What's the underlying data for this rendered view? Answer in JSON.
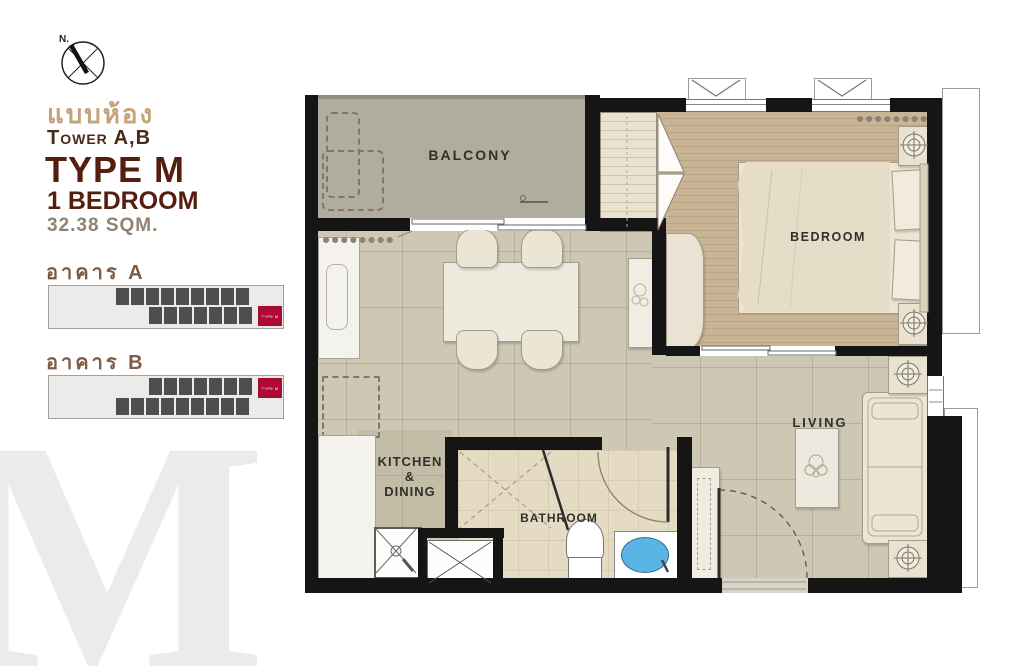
{
  "info_panel": {
    "compass_label": "N.",
    "title_thai": "แบบห้อง",
    "tower": "Tower A,B",
    "type": "TYPE M",
    "bedrooms": "1 BEDROOM",
    "area": "32.38 SQM.",
    "watermark": "M"
  },
  "buildings": [
    {
      "label": "อาคาร A",
      "highlight_label": "TYPE M",
      "rows": [
        {
          "cells": 9
        },
        {
          "cells": 7
        }
      ],
      "highlight_row": "bottom"
    },
    {
      "label": "อาคาร B",
      "highlight_label": "TYPE M",
      "rows": [
        {
          "cells": 7
        },
        {
          "cells": 9
        }
      ],
      "highlight_row": "top"
    }
  ],
  "plan": {
    "labels": {
      "balcony": "BALCONY",
      "bedroom": "BEDROOM",
      "living": "LIVING",
      "kitchen_line1": "KITCHEN",
      "kitchen_line2": "&",
      "kitchen_line3": "DINING",
      "bathroom": "BATHROOM"
    }
  },
  "colors": {
    "wall": "#151515",
    "balcony_fill": "#b1ad9e",
    "tile_fill": "#cdc7b4",
    "wood_fill": "#c9b595",
    "bathroom_fill": "#e4dbc2",
    "highlight_red": "#ad0a36",
    "unit_dark": "#4e4e4e",
    "basin_blue": "#5ab4e6",
    "brand_brown": "#551e0f",
    "thai_tan": "#c4a379"
  }
}
